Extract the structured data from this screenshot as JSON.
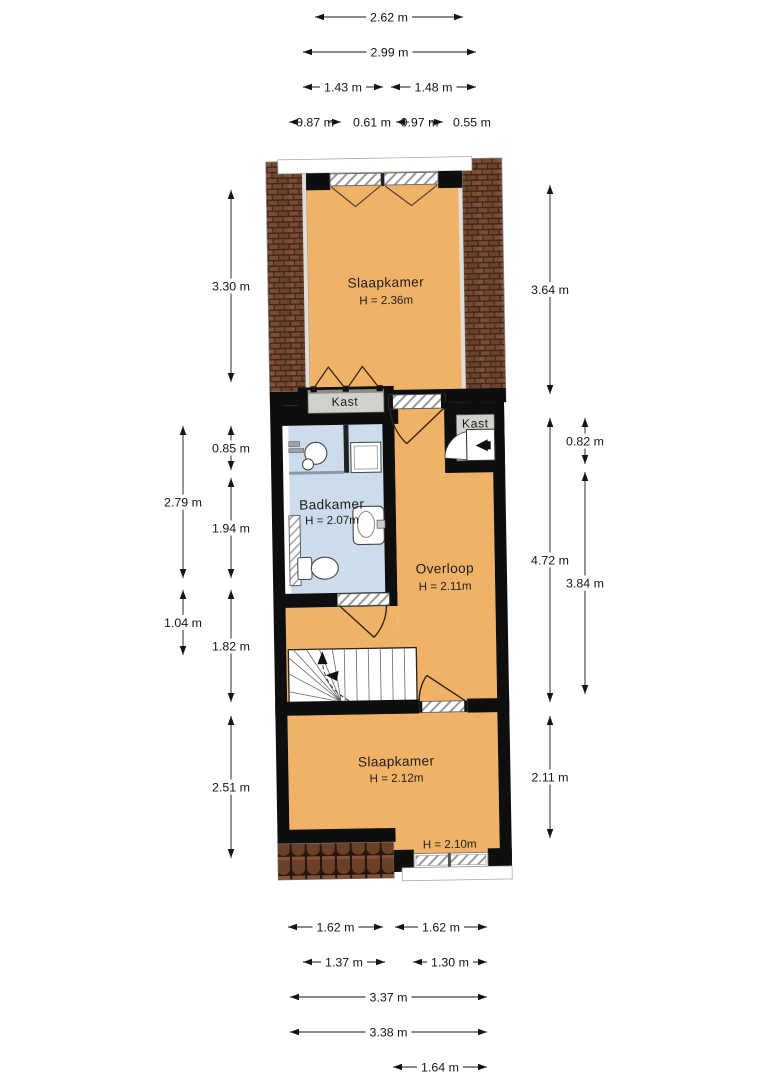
{
  "plan_type": "floorplan",
  "rooms": {
    "slaapkamer_top": {
      "name": "Slaapkamer",
      "height": "H = 2.36m"
    },
    "kast_top": {
      "name": "Kast"
    },
    "kast_right": {
      "name": "Kast"
    },
    "badkamer": {
      "name": "Badkamer",
      "height": "H = 2.07m"
    },
    "overloop": {
      "name": "Overloop",
      "height": "H = 2.11m"
    },
    "slaapkamer_bottom": {
      "name": "Slaapkamer",
      "height": "H = 2.12m"
    },
    "height_note": "H = 2.10m"
  },
  "dimensions": {
    "top": [
      "2.62 m",
      "2.99 m",
      "1.43 m",
      "1.48 m",
      "0.87 m",
      "0.61 m",
      "0.97 m",
      "0.55 m"
    ],
    "left": [
      "3.30 m",
      "0.85 m",
      "2.79 m",
      "1.94 m",
      "1.04 m",
      "1.82 m",
      "2.51 m"
    ],
    "right": [
      "3.64 m",
      "0.82 m",
      "4.72 m",
      "3.84 m",
      "2.11 m"
    ],
    "bottom": [
      "1.62 m",
      "1.62 m",
      "1.37 m",
      "1.30 m",
      "3.37 m",
      "3.38 m",
      "1.64 m"
    ]
  },
  "colors": {
    "floor_orange": "#efb266",
    "floor_blue": "#cddcec",
    "wall_black": "#0e0e0e",
    "closet_gray": "#d2d0cb",
    "roof_brick": "#7b4b34"
  }
}
